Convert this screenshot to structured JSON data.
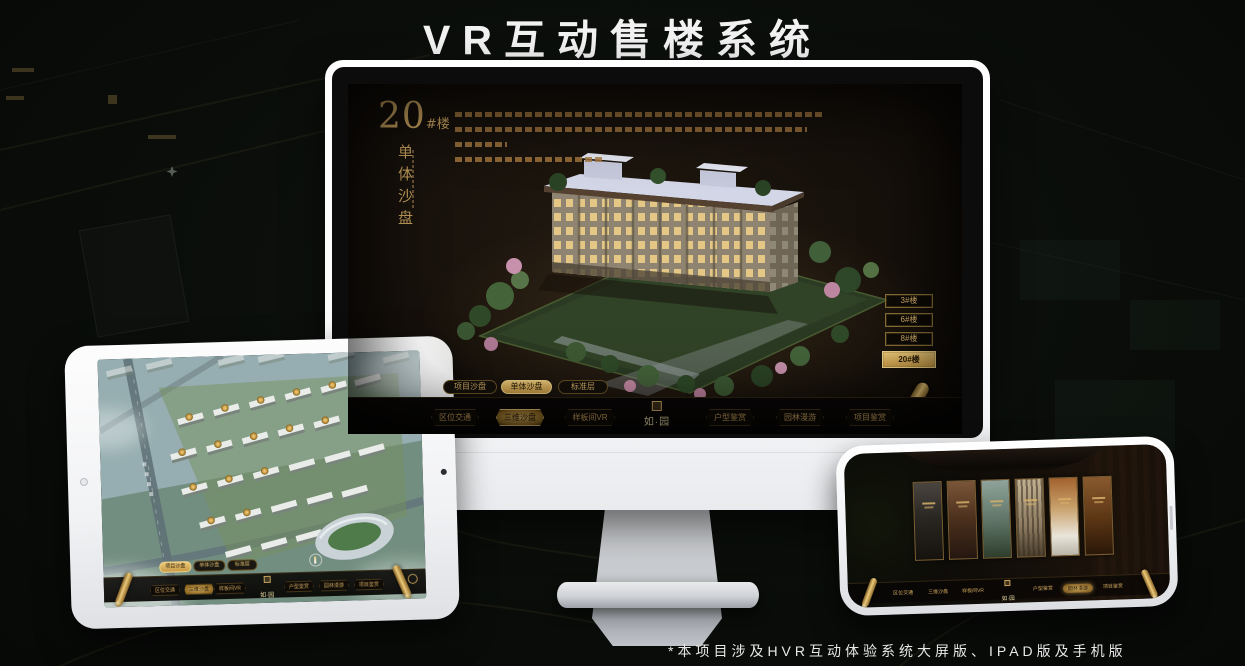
{
  "page": {
    "title": "VR互动售楼系统",
    "footnote": "*本项目涉及HVR互动体验系统大屏版、IPAD版及手机版"
  },
  "colors": {
    "gold": "#c9a25e",
    "gold_bright": "#ecc979",
    "gold_dark": "#8a6728",
    "screen_bg": "#171009"
  },
  "monitor_ui": {
    "headline": {
      "number": "20",
      "suffix": "#楼",
      "subtitle": "单体沙盘"
    },
    "building_buttons": [
      {
        "label": "3#楼",
        "active": false
      },
      {
        "label": "6#楼",
        "active": false
      },
      {
        "label": "8#楼",
        "active": false
      },
      {
        "label": "20#楼",
        "active": true
      }
    ],
    "mode_tabs": [
      {
        "label": "项目沙盘",
        "active": false
      },
      {
        "label": "单体沙盘",
        "active": true
      },
      {
        "label": "标准层",
        "active": false
      }
    ],
    "nav": {
      "logo": "如·园",
      "items": [
        {
          "label": "区位交通",
          "active": false
        },
        {
          "label": "三维沙盘",
          "active": true
        },
        {
          "label": "样板间VR",
          "active": false
        },
        {
          "label": "户型鉴赏",
          "active": false
        },
        {
          "label": "园林漫游",
          "active": false
        },
        {
          "label": "项目鉴赏",
          "active": false
        }
      ]
    }
  },
  "tablet_ui": {
    "mode_tabs": [
      {
        "label": "项目沙盘",
        "active": true
      },
      {
        "label": "单体沙盘",
        "active": false
      },
      {
        "label": "标准层",
        "active": false
      }
    ],
    "nav": {
      "logo": "如·园",
      "items": [
        {
          "label": "区位交通",
          "active": false
        },
        {
          "label": "三维沙盘",
          "active": true
        },
        {
          "label": "样板间VR",
          "active": false
        },
        {
          "label": "户型鉴赏",
          "active": false
        },
        {
          "label": "园林漫游",
          "active": false
        },
        {
          "label": "项目鉴赏",
          "active": false
        }
      ]
    }
  },
  "phone_ui": {
    "nav": {
      "logo": "如·园",
      "items": [
        {
          "label": "区位交通",
          "active": false
        },
        {
          "label": "三维沙盘",
          "active": false
        },
        {
          "label": "样板间VR",
          "active": false
        },
        {
          "label": "户型鉴赏",
          "active": false
        },
        {
          "label": "园林漫游",
          "active": true
        },
        {
          "label": "项目鉴赏",
          "active": false
        }
      ]
    }
  }
}
